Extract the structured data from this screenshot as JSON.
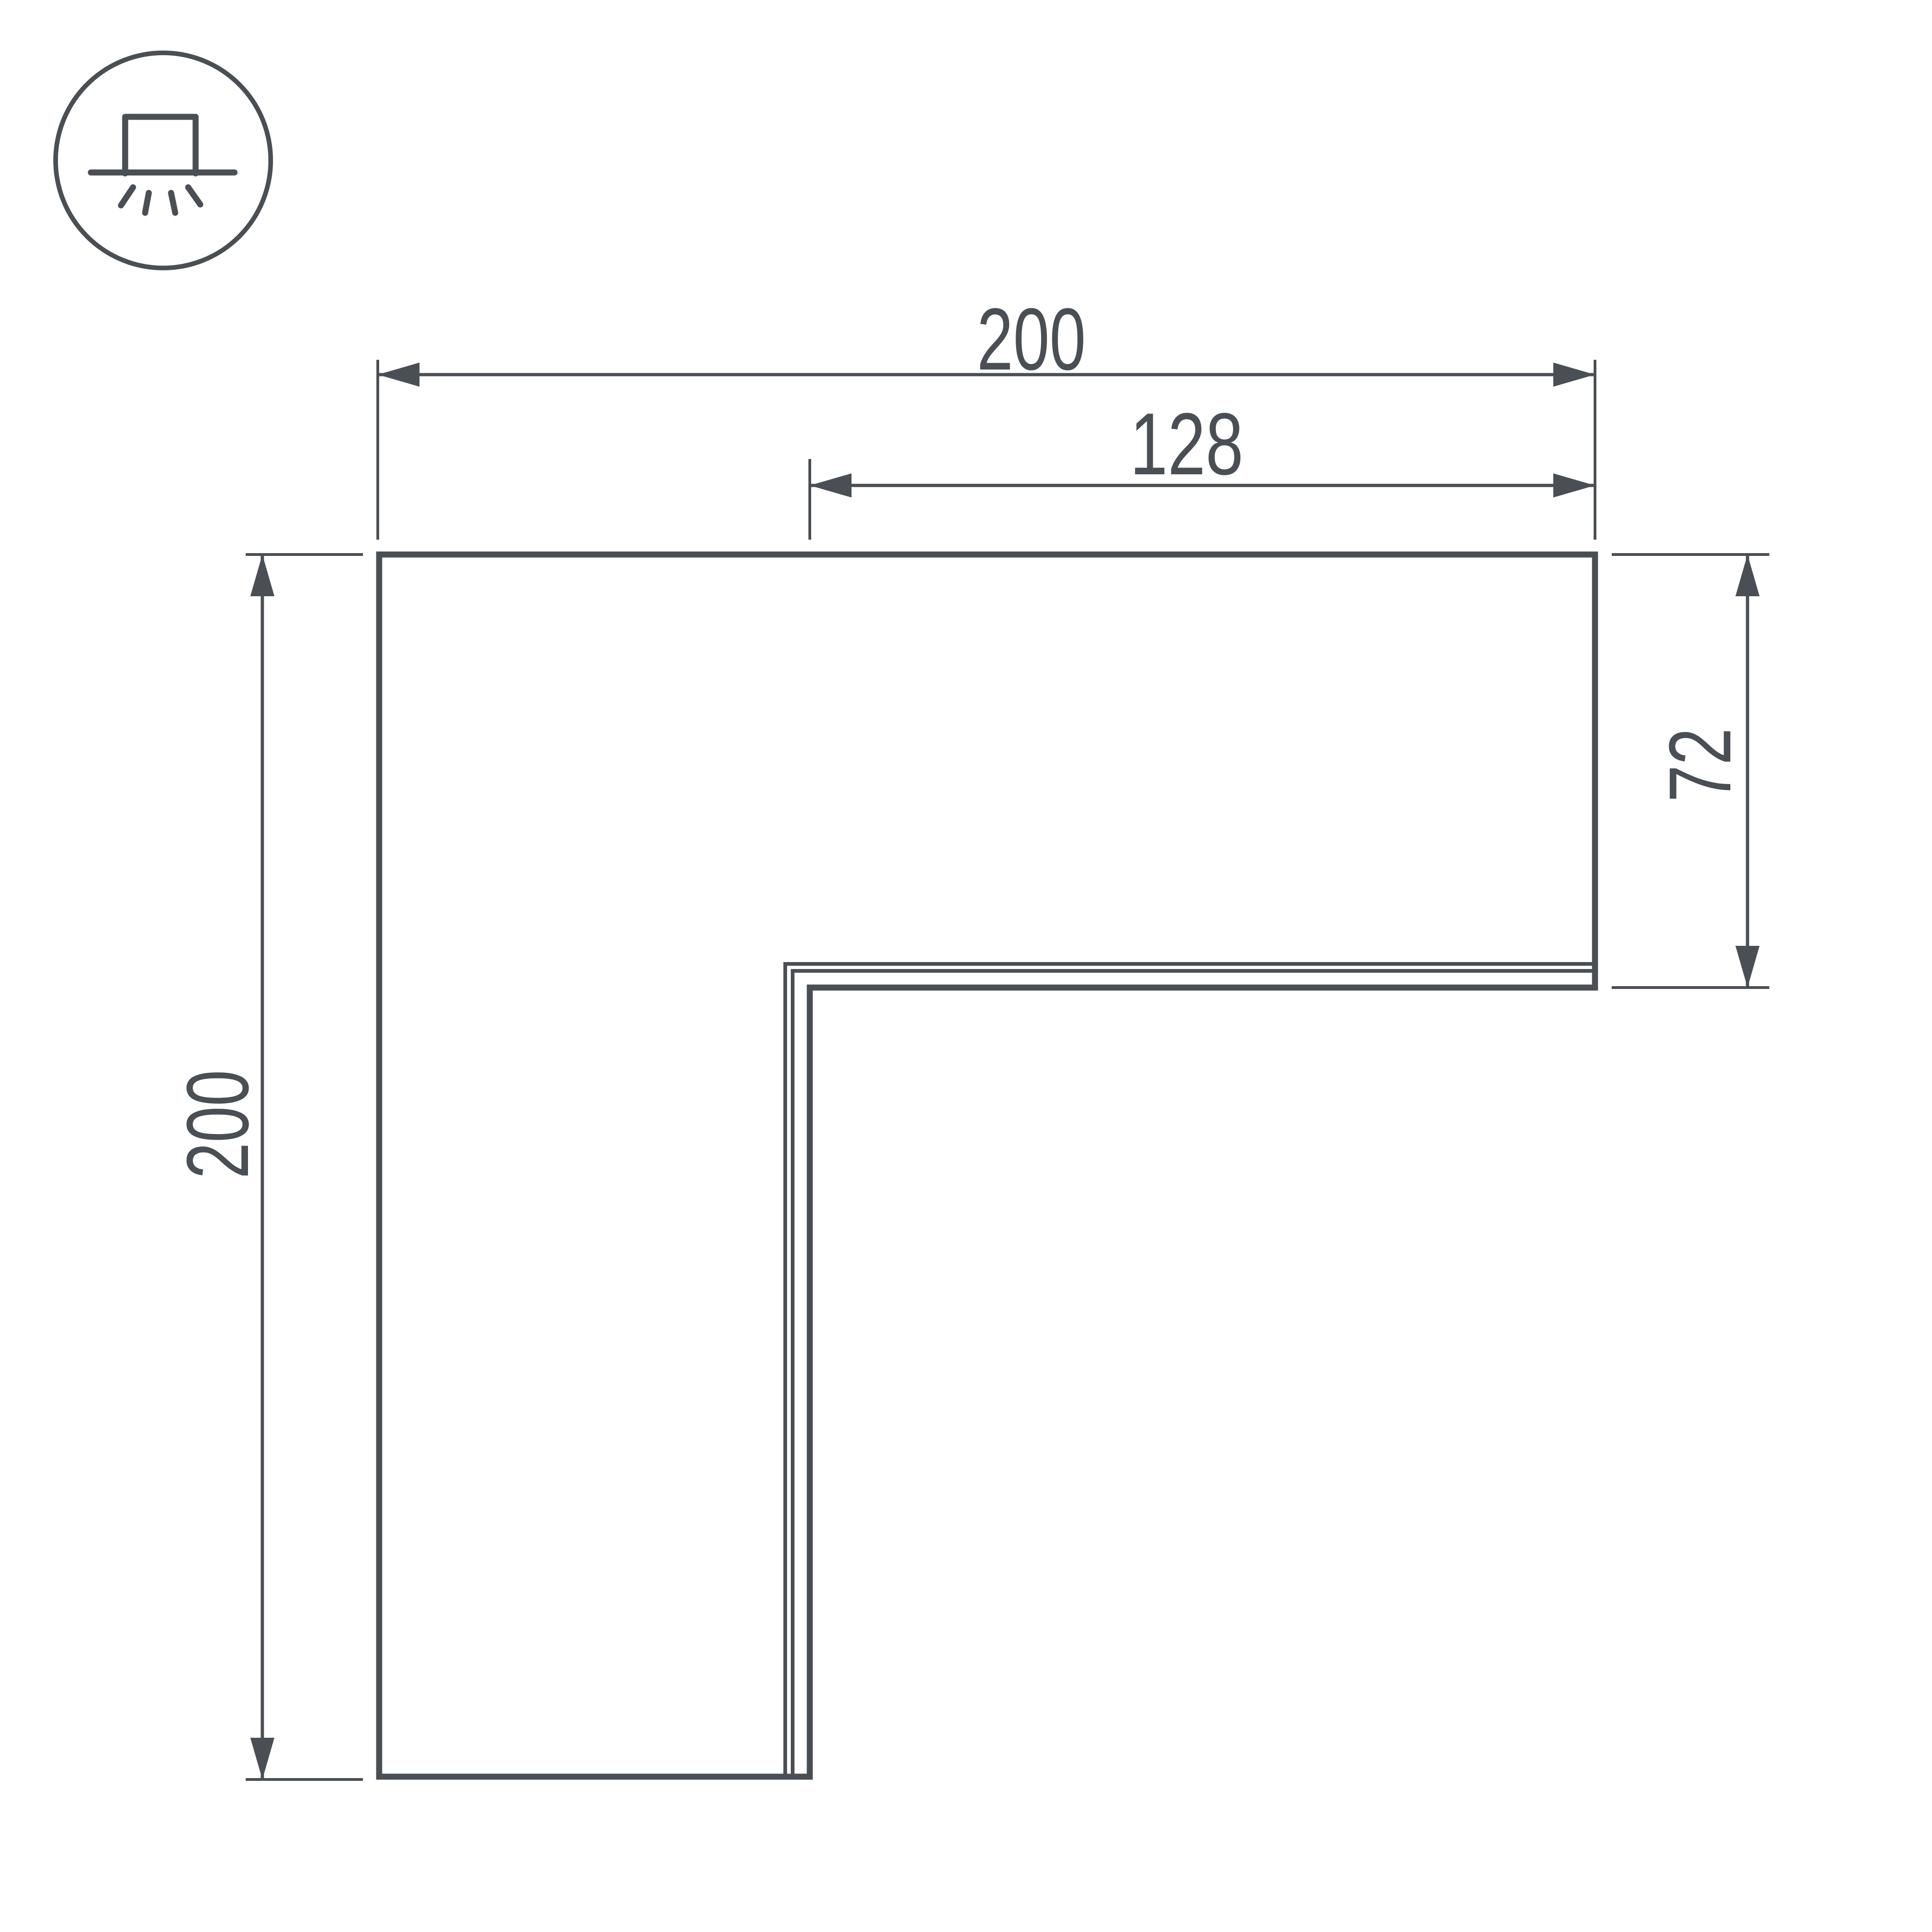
{
  "page": {
    "background": "#ffffff",
    "line_color": "#4a4f55"
  },
  "icon": {
    "name": "surface-mount-light-icon"
  },
  "dimensions": {
    "top_width": "200",
    "inner_width": "128",
    "left_height": "200",
    "right_height": "72"
  }
}
